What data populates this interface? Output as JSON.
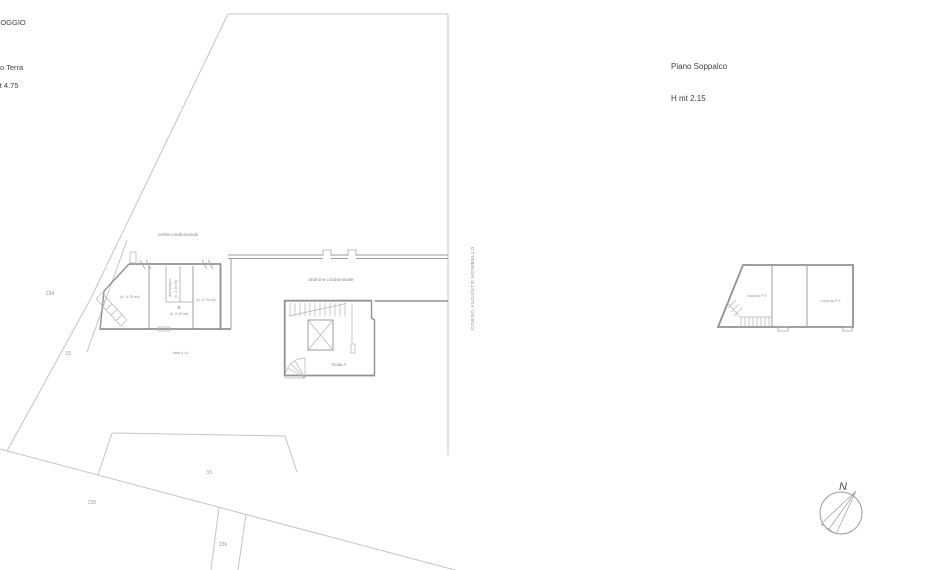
{
  "header_left": {
    "title": "ALLOGGIO",
    "floor": "Piano Terra",
    "height": "H mt 4.75"
  },
  "header_right": {
    "floor": "Piano Soppalco",
    "height": "H mt 2.15"
  },
  "street": {
    "name": "CORSO AUGUSTO MOMBELLO"
  },
  "ground_floor": {
    "courtyard": "cortile condominiale",
    "hall": "androne condominiale",
    "stair": "scala A",
    "unit": "B",
    "unit_height": "(h. 2.40 mt)",
    "hallway": "disimpegno",
    "hallway_height": "(h. 2.40 mt)",
    "room_left_height": "(h. 4.75 mt)",
    "room_right_height": "(h. 4.75 mt)",
    "other_unit": "altra u.i.u."
  },
  "mezzanine": {
    "void_left": "vuoto su P.T.",
    "void_right": "vuoto su P.T."
  },
  "parcels": {
    "n234": "234",
    "n33_upper": "33",
    "n33_lower": "33",
    "n235": "235",
    "n236": "236"
  },
  "compass": {
    "north": "N"
  },
  "colors": {
    "background": "#ffffff",
    "parcel_line": "#c5c5c8",
    "wall": "#90909a",
    "hatch": "#b5b5bc",
    "label_text": "#8a8a8a",
    "header_text": "#3f3f3f"
  }
}
